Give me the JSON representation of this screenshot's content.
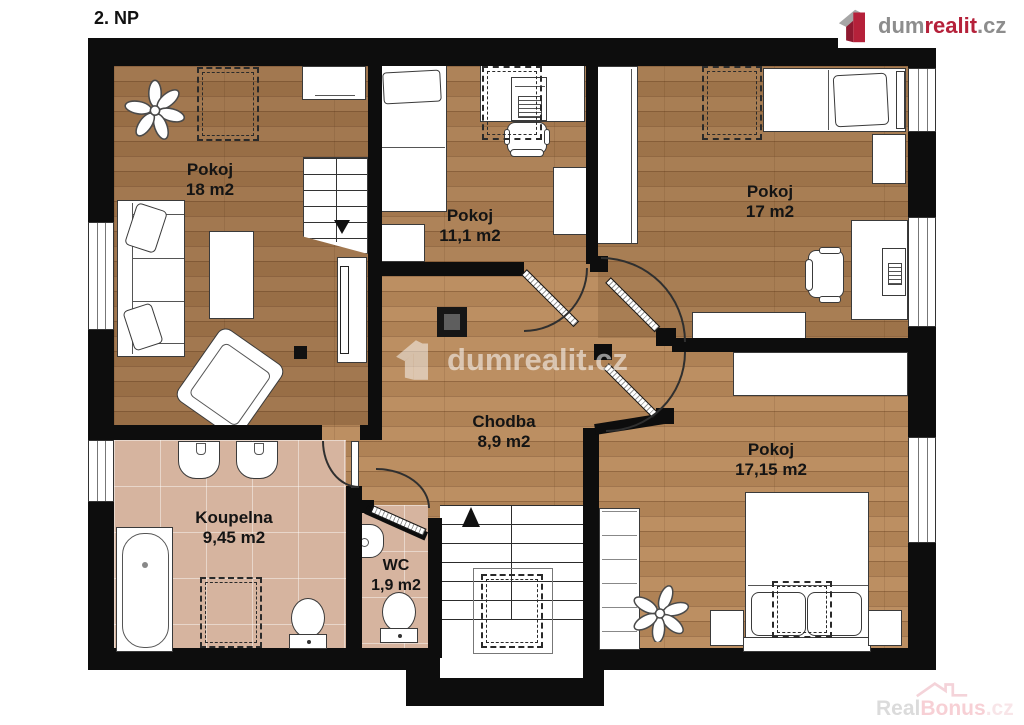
{
  "page": {
    "title": "2. NP"
  },
  "branding": {
    "logo": {
      "dum": "dum",
      "realit": "realit",
      "cz": ".cz"
    },
    "center_watermark": {
      "text": "dumrealit.cz"
    },
    "bottom_watermark": {
      "real": "Real",
      "bonus": "Bonus",
      "cz": ".cz"
    }
  },
  "rooms": [
    {
      "name": "Pokoj",
      "area": "18 m2"
    },
    {
      "name": "Pokoj",
      "area": "11,1 m2"
    },
    {
      "name": "Pokoj",
      "area": "17 m2"
    },
    {
      "name": "Chodba",
      "area": "8,9 m2"
    },
    {
      "name": "Koupelna",
      "area": "9,45 m2"
    },
    {
      "name": "WC",
      "area": "1,9 m2"
    },
    {
      "name": "Pokoj",
      "area": "17,15 m2"
    }
  ],
  "colors": {
    "wall": "#0d0d0d",
    "wood_floor": "#b8895a",
    "tile_floor": "#d6b49f",
    "brand_red": "#b5213a",
    "brand_gray": "#8d8d8d"
  }
}
